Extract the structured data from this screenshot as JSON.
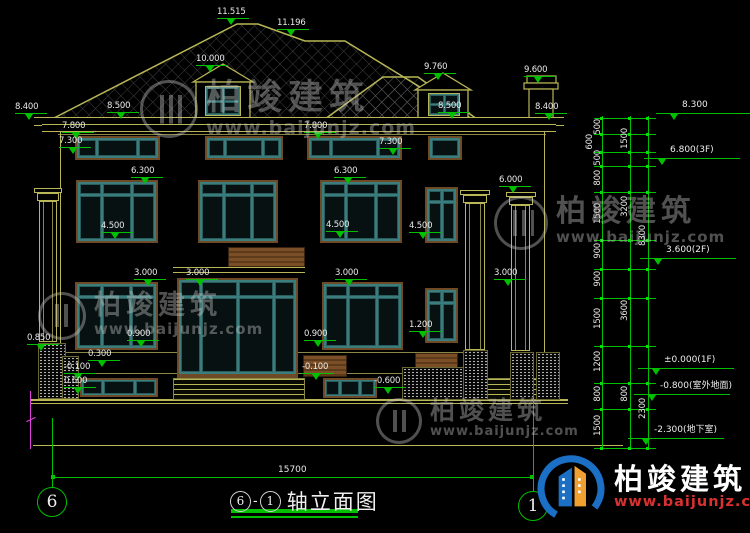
{
  "drawing": {
    "title": {
      "left_axis": "6",
      "dash": "-",
      "right_axis": "1",
      "name": "轴立面图"
    },
    "axis_bubbles": {
      "left": "6",
      "right": "1"
    },
    "overall_width_dim": "15700",
    "colors": {
      "background": "#000000",
      "dimension_green": "#00c000",
      "outline_yellow": "#b9b656",
      "window_teal": "#3b7d7d",
      "frame_brown": "#6f4a26",
      "text_white": "#e9e9e9",
      "axis_magenta": "#e040e0",
      "logo_blue": "#1b6fc4",
      "logo_orange": "#f0a030",
      "url_red": "#d93030"
    },
    "elevation_labels": [
      {
        "t": "11.515",
        "x": 217,
        "y": 8
      },
      {
        "t": "11.196",
        "x": 277,
        "y": 19
      },
      {
        "t": "10.000",
        "x": 196,
        "y": 55
      },
      {
        "t": "8.400",
        "x": 15,
        "y": 103
      },
      {
        "t": "8.500",
        "x": 107,
        "y": 102
      },
      {
        "t": "9.760",
        "x": 424,
        "y": 63
      },
      {
        "t": "9.600",
        "x": 524,
        "y": 66
      },
      {
        "t": "8.500",
        "x": 438,
        "y": 102
      },
      {
        "t": "8.400",
        "x": 535,
        "y": 103
      },
      {
        "t": "7.800",
        "x": 62,
        "y": 122
      },
      {
        "t": "7.800",
        "x": 304,
        "y": 122
      },
      {
        "t": "7.300",
        "x": 59,
        "y": 137
      },
      {
        "t": "7.300",
        "x": 379,
        "y": 138
      },
      {
        "t": "6.300",
        "x": 131,
        "y": 167
      },
      {
        "t": "6.300",
        "x": 334,
        "y": 167
      },
      {
        "t": "6.000",
        "x": 499,
        "y": 176
      },
      {
        "t": "4.500",
        "x": 101,
        "y": 222
      },
      {
        "t": "4.500",
        "x": 326,
        "y": 221
      },
      {
        "t": "4.500",
        "x": 409,
        "y": 222
      },
      {
        "t": "3.000",
        "x": 134,
        "y": 269
      },
      {
        "t": "3.000",
        "x": 186,
        "y": 269
      },
      {
        "t": "3.000",
        "x": 335,
        "y": 269
      },
      {
        "t": "3.000",
        "x": 494,
        "y": 269
      },
      {
        "t": "0.850",
        "x": 27,
        "y": 334
      },
      {
        "t": "0.900",
        "x": 127,
        "y": 330
      },
      {
        "t": "0.900",
        "x": 304,
        "y": 330
      },
      {
        "t": "1.200",
        "x": 409,
        "y": 321
      },
      {
        "t": "0.300",
        "x": 88,
        "y": 350
      },
      {
        "t": "-0.100",
        "x": 64,
        "y": 363
      },
      {
        "t": "-0.100",
        "x": 302,
        "y": 363
      },
      {
        "t": "0.600",
        "x": 64,
        "y": 377
      },
      {
        "t": "-0.600",
        "x": 374,
        "y": 377
      }
    ],
    "right_markers": [
      {
        "t": "8.300",
        "x": 668,
        "y": 100
      },
      {
        "t": "6.800(3F)",
        "x": 656,
        "y": 145
      },
      {
        "t": "3.600(2F)",
        "x": 652,
        "y": 245
      },
      {
        "t": "±0.000(1F)",
        "x": 650,
        "y": 355
      },
      {
        "t": "-0.800(室外地面)",
        "x": 646,
        "y": 381
      },
      {
        "t": "-2.300(地下室)",
        "x": 640,
        "y": 425
      }
    ],
    "right_dims": {
      "col1": [
        {
          "t": "500",
          "x": 593,
          "y": 119
        },
        {
          "t": "600",
          "x": 585,
          "y": 134
        },
        {
          "t": "500",
          "x": 593,
          "y": 150
        },
        {
          "t": "800",
          "x": 593,
          "y": 170
        },
        {
          "t": "1500",
          "x": 593,
          "y": 203
        },
        {
          "t": "900",
          "x": 593,
          "y": 243
        },
        {
          "t": "900",
          "x": 593,
          "y": 271
        },
        {
          "t": "1500",
          "x": 593,
          "y": 308
        },
        {
          "t": "1200",
          "x": 593,
          "y": 351
        },
        {
          "t": "800",
          "x": 593,
          "y": 386
        },
        {
          "t": "1500",
          "x": 593,
          "y": 415
        }
      ],
      "col2": [
        {
          "t": "1500",
          "x": 620,
          "y": 128
        },
        {
          "t": "3200",
          "x": 620,
          "y": 196
        },
        {
          "t": "3600",
          "x": 620,
          "y": 300
        },
        {
          "t": "800",
          "x": 620,
          "y": 386
        }
      ],
      "col3": [
        {
          "t": "8300",
          "x": 638,
          "y": 225
        },
        {
          "t": "2300",
          "x": 638,
          "y": 398
        }
      ],
      "tick_ys": [
        {
          "y": 118
        },
        {
          "y": 134
        },
        {
          "y": 152
        },
        {
          "y": 166
        },
        {
          "y": 192
        },
        {
          "y": 240
        },
        {
          "y": 269
        },
        {
          "y": 298
        },
        {
          "y": 346
        },
        {
          "y": 383
        },
        {
          "y": 409
        },
        {
          "y": 448
        }
      ]
    },
    "watermark": {
      "brand": "柏竣建筑",
      "url": "www.baijunjz.com"
    },
    "footer_logo": {
      "brand": "柏竣建筑",
      "url": "www.baijunjz.com"
    }
  }
}
